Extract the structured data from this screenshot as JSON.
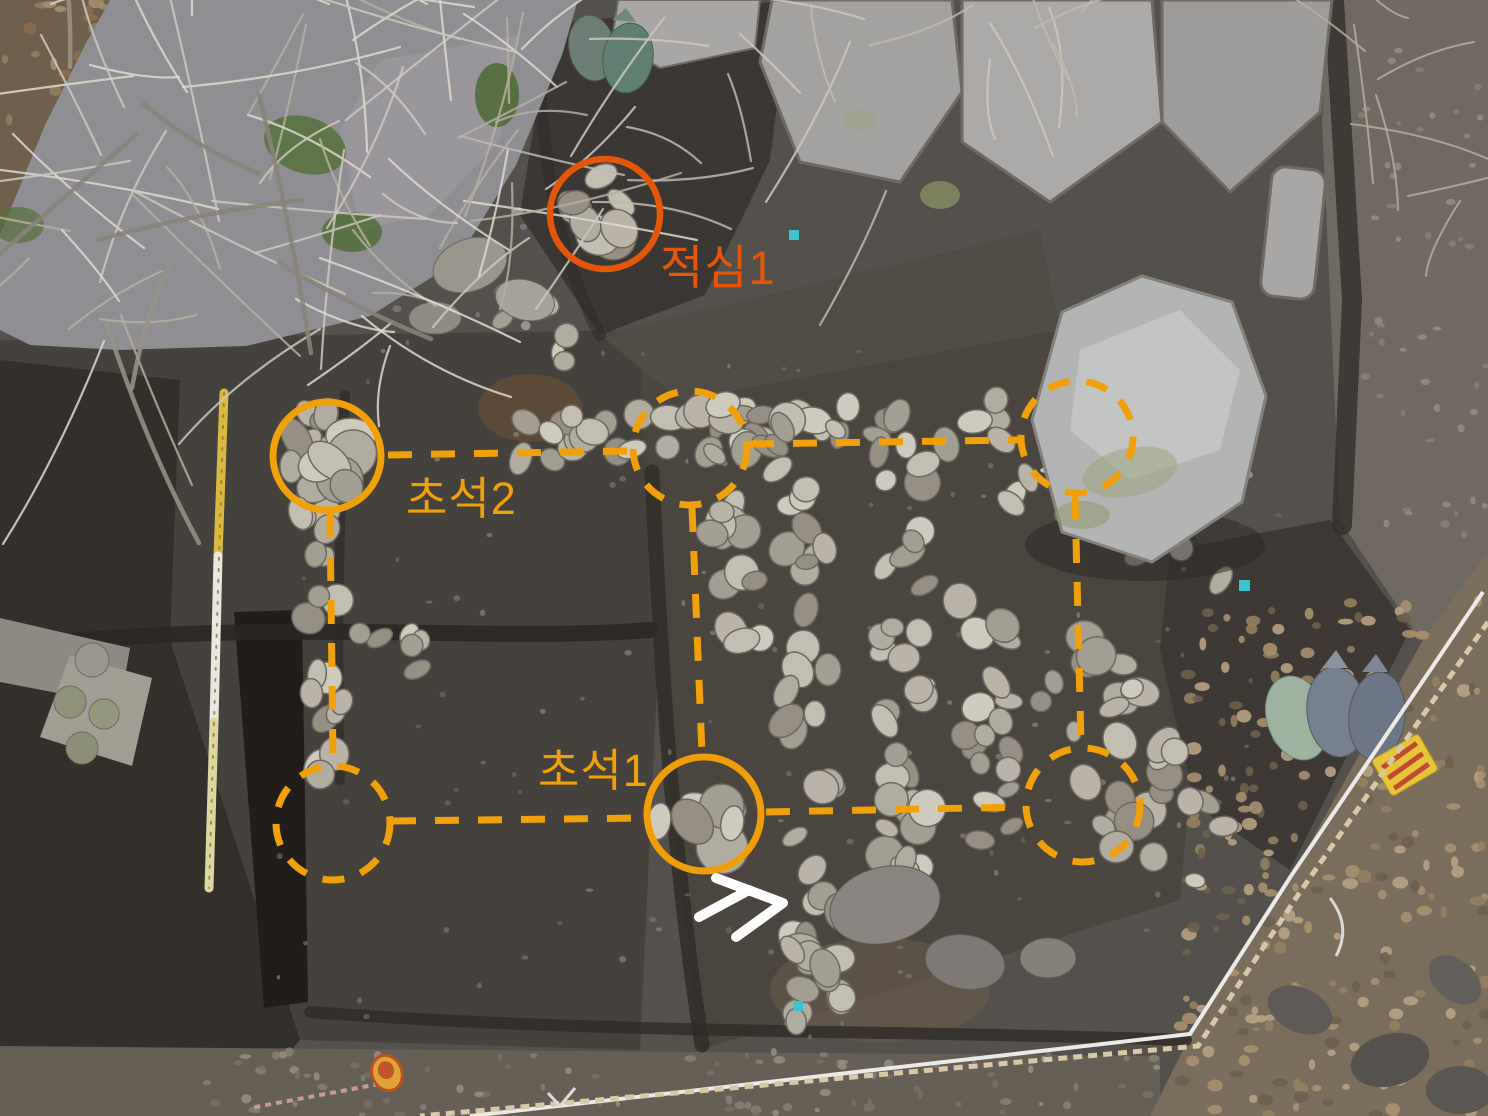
{
  "photo": {
    "kind": "excavation-aerial-photo",
    "annotations": {
      "labels": [
        {
          "id": "jeoksim-1",
          "text": "적심1",
          "color": "#e4570a"
        },
        {
          "id": "choseok-2",
          "text": "초석2",
          "color": "#f0a10a"
        },
        {
          "id": "choseok-1",
          "text": "초석1",
          "color": "#f0a10a"
        }
      ],
      "accent_orange": "#f0a10a",
      "accent_red_orange": "#e4570a",
      "north_arrow_color": "#ffffff"
    }
  }
}
